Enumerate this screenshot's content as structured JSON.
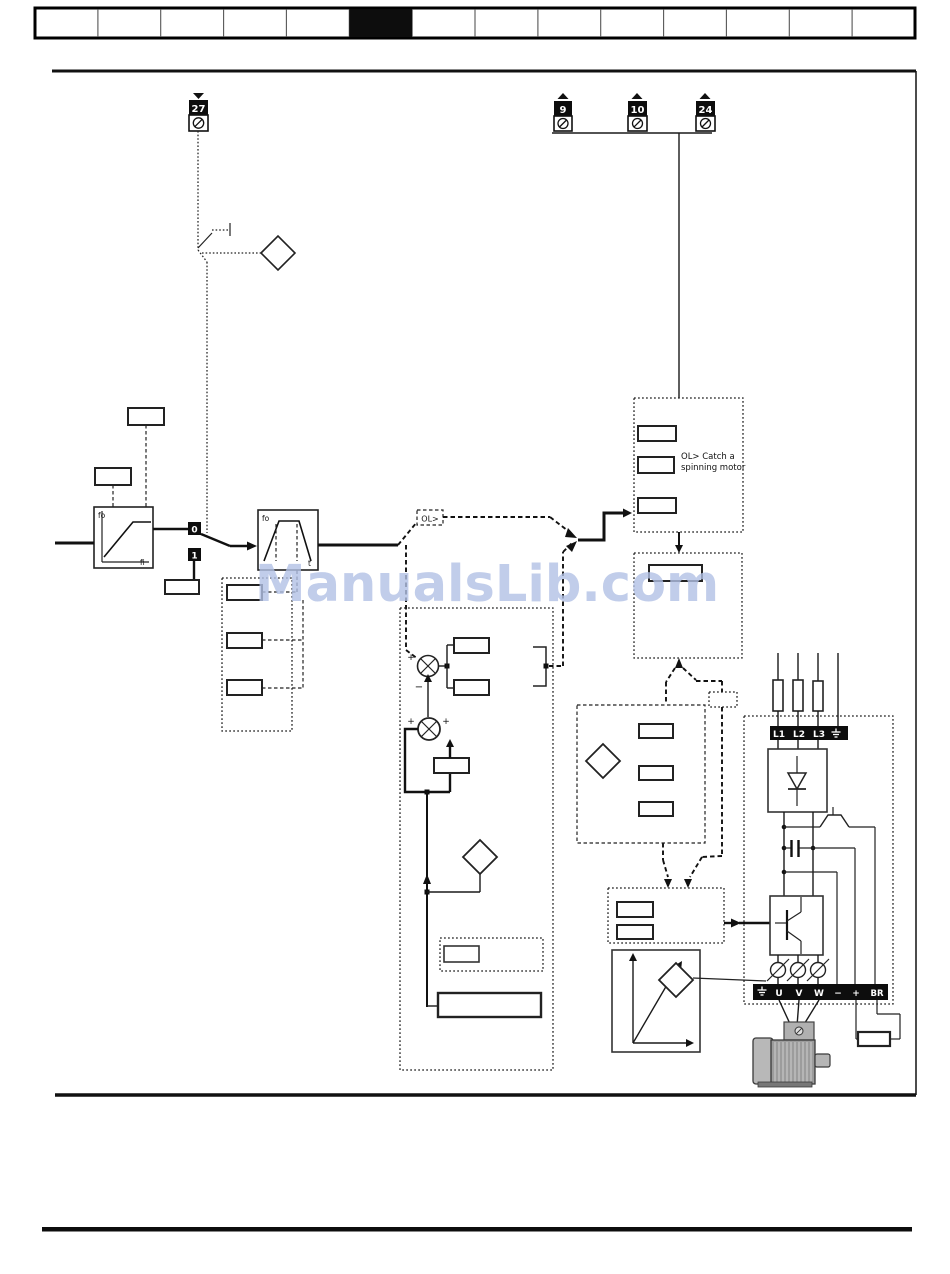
{
  "page": {
    "watermark_text": "ManualsLib.com",
    "watermark_color": "#b2c1e5"
  },
  "header": {
    "cells": 14,
    "active_index": 5
  },
  "terminals": {
    "t27": "27",
    "t9": "9",
    "t10": "10",
    "t24": "24"
  },
  "annotations": {
    "ol_tag": "OL>",
    "catch_line1": "OL> Catch a",
    "catch_line2": "spinning motor"
  },
  "graphs": {
    "minmax_y_label": "fo",
    "minmax_x_label": "fi",
    "ramp_y_label": "fo",
    "ramp_x_label": "t"
  },
  "switch": {
    "pos0": "0",
    "pos1": "1"
  },
  "summing": {
    "sum1_plus": "+",
    "sum1_minus": "−",
    "sum2_left": "+",
    "sum2_right": "+"
  },
  "power": {
    "input_terminals": [
      "L1",
      "L2",
      "L3"
    ],
    "output_terminals": [
      "U",
      "V",
      "W",
      "−",
      "+",
      "BR"
    ]
  }
}
